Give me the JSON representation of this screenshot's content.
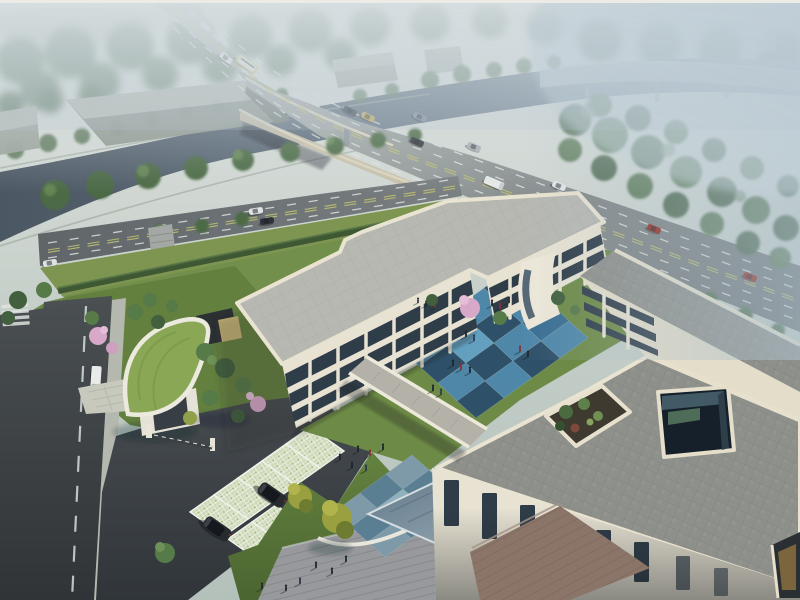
{
  "scene": {
    "title": "Campus aerial rendering",
    "description": "Bird's-eye photorealistic architectural rendering of a cream three-storey courtyard building complex beside a tree-lined canal and a curving highway bridge, seen through soft morning haze",
    "time_of_day": "hazy morning",
    "style": "photorealistic CG visualization, no text or UI elements visible"
  },
  "background": {
    "sky": "hazy pale grey-blue mist over distant fields",
    "features": [
      "misty tree line",
      "pale farm fields",
      "distant elevated viaduct",
      "dark canal",
      "grey warehouse sheds",
      "faint white house"
    ]
  },
  "infrastructure": {
    "canal": {
      "direction": "from left edge diagonally to upper right",
      "water_color": "#4e5b68",
      "banks": "tree lined"
    },
    "highway_bridge": {
      "lanes": 6,
      "path": "curves from top-left over the canal down to the lower right",
      "barrier_color": "#dbd5c1",
      "median": "yellow dashed double line"
    },
    "frontage_road": {
      "position": "south of canal, merges with highway",
      "median": "yellow dashed double line"
    },
    "city_street": {
      "position": "bottom-left, runs vertically past the site entrance",
      "markings": [
        "white dashed center line",
        "zebra crosswalk"
      ]
    },
    "viaduct": {
      "position": "upper-right corner, fading into haze"
    }
  },
  "campus": {
    "buildings": {
      "west_wing": {
        "storeys": 3,
        "facade": "cream stone piers with dark glazed window bands",
        "roof": "light grey deck with cream parapet, rounded corners"
      },
      "north_wing": {
        "storeys": 3,
        "feature": "rounded cream pavilion with curved glass strip"
      },
      "east_wing": {
        "storeys": 3,
        "position": "parallel to highway on the right"
      },
      "south_building": {
        "roof": "large grey paver deck",
        "features": [
          "square atrium lightwell with glass walls",
          "roof-garden planter with shrubs",
          "corner window glowing warm at lower right"
        ]
      },
      "link_bridge": {
        "type": "elevated walkway across courtyard",
        "deck": "grey pavers with cream parapets"
      }
    },
    "courtyard": {
      "paving": "checkerboard of light blue and navy square tiles",
      "people_count": 15,
      "landscape": [
        "pink blossom tree",
        "small green trees",
        "lawn edge"
      ]
    },
    "entrance_plaza": {
      "paving": "muted blue-grey checkerboard",
      "people_count": 6
    },
    "south_plaza": {
      "paving": "striped grey pavers",
      "people_count": 6
    },
    "water_feature": "rectangular reflecting pool beside south building",
    "terrace": "warm brown paved entry terrace",
    "gatehouse": {
      "roof": "curved green sedum roof with white fascia",
      "gate": "dark sliding barrier with cream pillars",
      "extra": "dark pergola with sand pit behind"
    },
    "parking": {
      "surface": "grass-grid pavers",
      "stalls": 8,
      "occupied_by": "2 dark SUVs"
    },
    "landscape": [
      "pink cherry trees",
      "clipped dark hedge along road",
      "sloped lawns",
      "yellow-green feature trees"
    ]
  },
  "vehicles": {
    "bridge_road": [
      "white car",
      "cream bus",
      "white box truck",
      "white van",
      "dark car",
      "tan car",
      "grey car",
      "dark car",
      "silver car",
      "red car",
      "red car",
      "two faint distant cars"
    ],
    "frontage_road": [
      "white car",
      "dark car"
    ],
    "street": [
      "white delivery van",
      "dark car at junction"
    ],
    "parked": [
      "two white cars by frontage road",
      "two black SUVs in grass-grid stalls"
    ]
  },
  "people": {
    "total_visible": 29,
    "areas": [
      "blue courtyard",
      "entrance plaza",
      "south plaza",
      "north lawn"
    ],
    "detail": "tiny figures with long shadows cast toward lower-left"
  },
  "colors": {
    "sky_top": "#e7e9e6",
    "haze": "#b7c5ce",
    "water": "#4e5b68",
    "water_far": "#93a7b3",
    "road_asphalt": "#6f7577",
    "road_bridge": "#aab0ae",
    "road_street": "#42474b",
    "lane_white": "#e3e7e5",
    "lane_yellow": "#bfc173",
    "roof_light": "#b7b8b2",
    "roof_dark": "#8e908b",
    "parapet": "#e9e3d1",
    "wall_cream": "#e7e2d2",
    "window_dark": "#2f3d49",
    "tile_blue_light": "#4f87a9",
    "tile_blue_dark": "#2e5068",
    "tile_grey_light": "#7e9aa9",
    "tile_grey_dark": "#5a7e92",
    "grass_bright": "#6d8a46",
    "grass_deep": "#4e6832",
    "green_roof": "#89a755",
    "hedge": "#3c5433",
    "tree_dark": "#42603e",
    "tree_mid": "#567a48",
    "tree_light": "#6e9158",
    "blossom_pink": "#d7a8c8",
    "paver_light": "#c6c9bb",
    "plaza_grey": "#97999c",
    "terrace_brown": "#8b7468",
    "pool": "#7f93a0",
    "car_red": "#93291e",
    "vehicle_white": "#e9ebe9",
    "suv_dark": "#262b30",
    "bus_cream": "#d9cf9f"
  }
}
